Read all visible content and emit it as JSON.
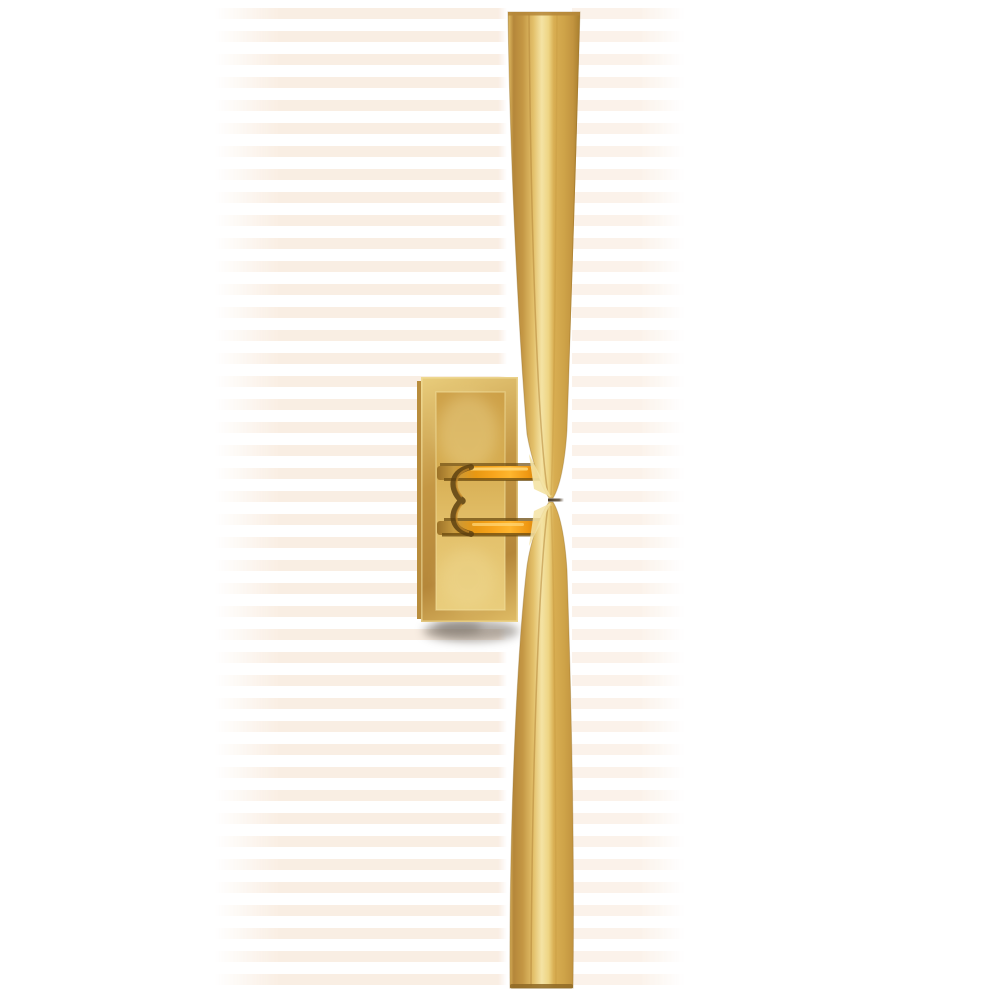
{
  "scene": {
    "description": "Product photo of a tall linear wall sconce in antique brass: two long tapered spikes meeting tip-to-tip at the center, held by a small bracket on a rectangular beveled backplate; soft shadow below the backplate on a white background.",
    "object": "linear wall sconce",
    "material": "hand-rubbed antique brass"
  },
  "colors": {
    "background": "#ffffff",
    "brass_highlight": "#f4e3a4",
    "brass_light": "#e9cd7c",
    "brass_mid": "#d5ab4f",
    "brass_deep": "#b5873a",
    "brass_shadow": "#8f6a26",
    "amber_glow": "#f7a41c",
    "amber_bright": "#ffb62e",
    "amber_dark": "#6e4d12",
    "bracket_shade": "#5c3f10",
    "waist_line": "#4a3a26",
    "cast_shadow": "#6b6258",
    "artifact_band": "#f2d7bd"
  }
}
